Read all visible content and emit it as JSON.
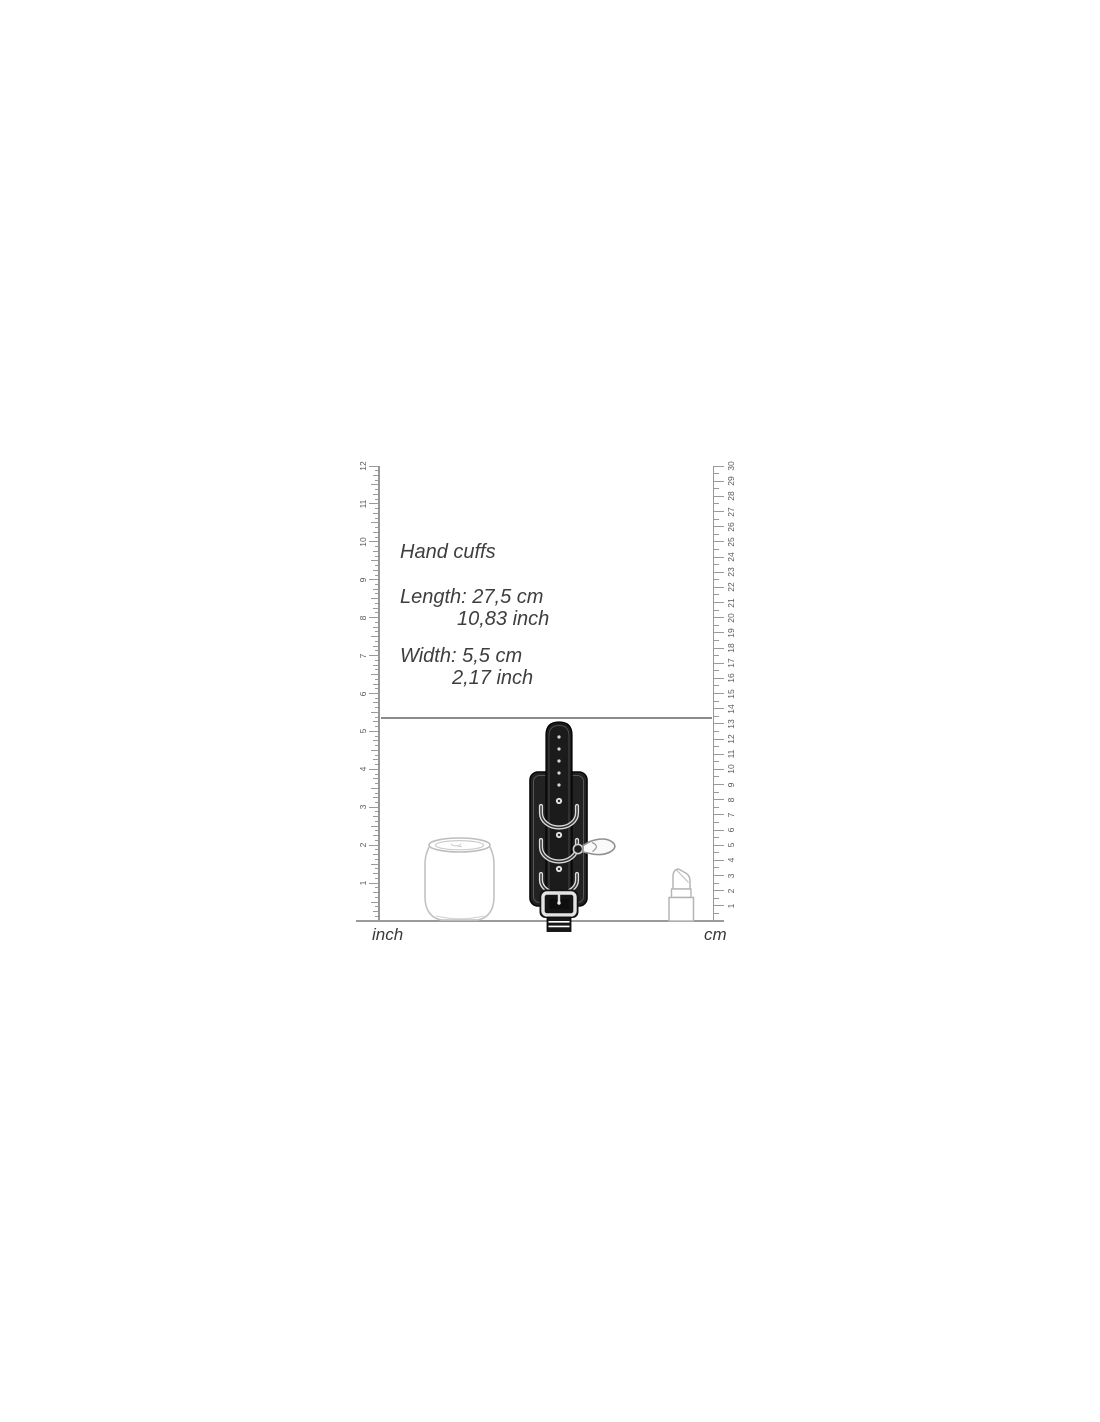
{
  "product": {
    "title": "Hand cuffs",
    "dimensions": {
      "length_label": "Length:",
      "length_cm": "27,5 cm",
      "length_inch": "10,83 inch",
      "width_label": "Width:",
      "width_cm": "5,5 cm",
      "width_inch": "2,17 inch"
    }
  },
  "rulers": {
    "left": {
      "unit_label": "inch",
      "max": 12,
      "minor_per_unit": 8
    },
    "right": {
      "unit_label": "cm",
      "max": 30,
      "minor_per_unit": 2
    }
  },
  "reference_objects": {
    "left": "soda-can outline",
    "center": "black hand cuff with strap, D-rings, snap hook and buckle",
    "right": "lipstick outline"
  },
  "colors": {
    "ruler_line": "#979797",
    "tick": "#9a9a9a",
    "ruler_number": "#5a5a5a",
    "body_text": "#3e3e3e",
    "baseline": "#9b9b9b",
    "dimension_line": "#8a8a8a",
    "product_black": "#1d1d1d",
    "outline_gray": "#c0c0c0"
  }
}
